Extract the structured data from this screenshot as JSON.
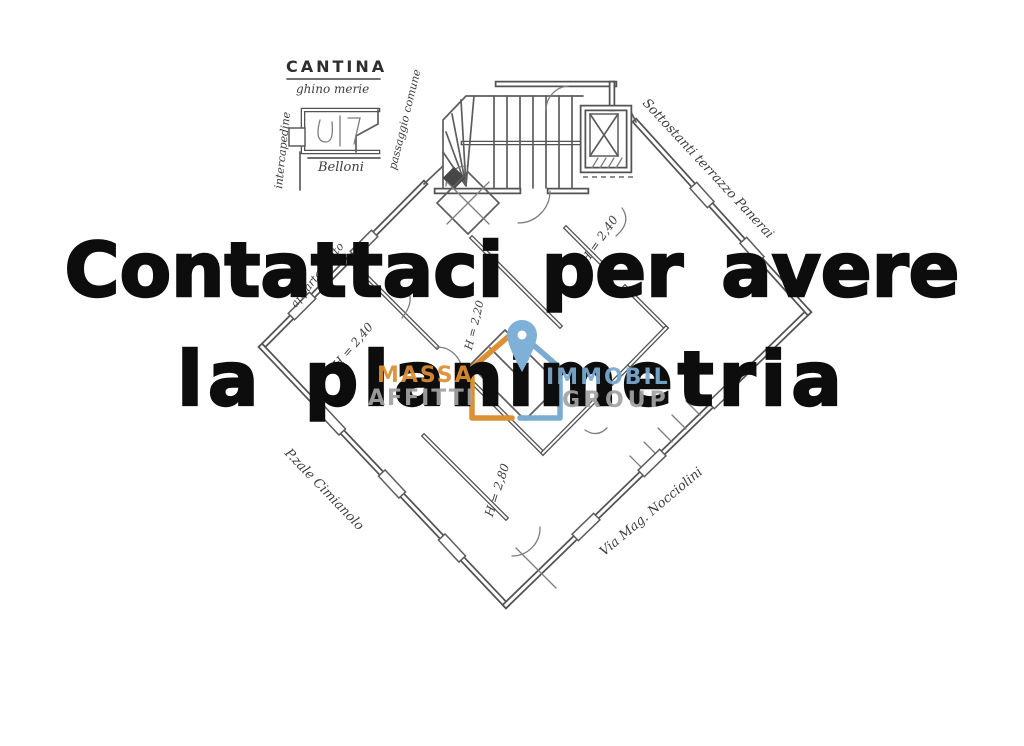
{
  "image": {
    "width": 1024,
    "height": 746
  },
  "overlay": {
    "line1": "Contattaci per avere",
    "line2": "la planimetria",
    "color": "#0d0d0d"
  },
  "watermark": {
    "left_top": "MASSA",
    "left_bottom": "AFFITTI",
    "right_top": "IMMOBIL",
    "right_bottom": "GROUP",
    "orange": "#dd8f33",
    "blue": "#7aabd0",
    "gray": "#a3a3a3",
    "pin_blue": "#7fb0d8"
  },
  "plan": {
    "ink": "#3c3c3c",
    "cantina": {
      "title": "CANTINA",
      "subtitle": "ghino merie",
      "left_note": "intercapedine",
      "right_note": "passaggio comune",
      "bottom_note": "Belloni"
    },
    "notes": {
      "terrace": "Sottostanti terrazzo Panerai",
      "side": "appartamento",
      "h_left": "H = 2,40",
      "h_top_right": "H = 2,40",
      "h_center": "H = 2,20",
      "h_bottom": "H = 2,80",
      "street_left": "P.zale Cimianolo",
      "street_right": "Via Mag. Nocciolini"
    }
  }
}
